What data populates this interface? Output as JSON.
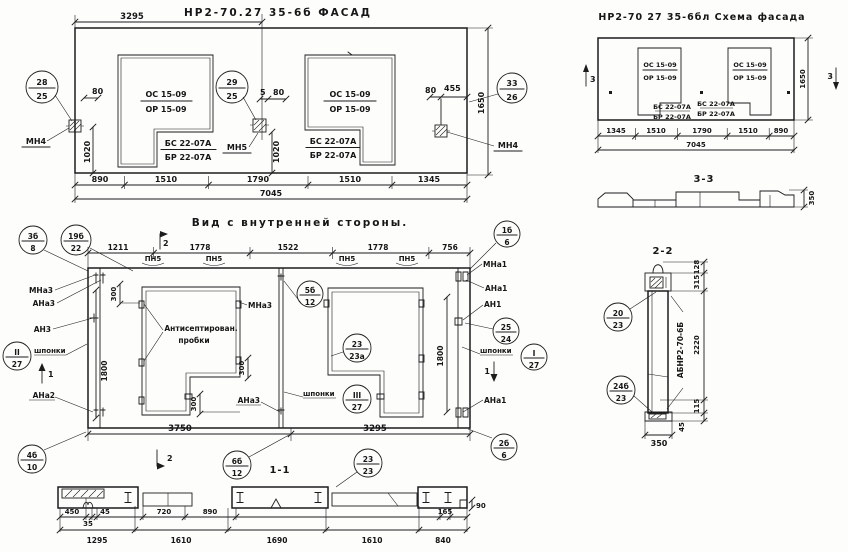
{
  "facade": {
    "title": "НР2-70.27 35-6б  ФАСАД",
    "dim_3295": "3295",
    "c28": {
      "n": "28",
      "d": "25"
    },
    "c29": {
      "n": "29",
      "d": "25"
    },
    "c33": {
      "n": "33",
      "d": "26"
    },
    "mn4_left": "МН4",
    "mn5": "МН5",
    "mn4_right": "МН4",
    "d80l": "80",
    "d1020l": "1020",
    "d5": "5",
    "d80m": "80",
    "d1020m": "1020",
    "d80r": "80",
    "d455": "455",
    "d1650": "1650",
    "w1": {
      "a": "ОС 15-09",
      "b": "ОР 15-09",
      "c": "БС 22-07А",
      "d": "БР 22-07А"
    },
    "w2": {
      "a": "ОС 15-09",
      "b": "ОР 15-09",
      "c": "БС 22-07А",
      "d": "БР 22-07А"
    },
    "db": [
      "890",
      "1510",
      "1790",
      "1510",
      "1345"
    ],
    "total": "7045"
  },
  "schema": {
    "title": "НР2-70 27 35-6бл  Схема фасада",
    "w1": {
      "a": "ОС 15-09",
      "b": "ОР 15-09",
      "c": "БС 22-07А",
      "d": "БР 22-07А"
    },
    "w2": {
      "a": "ОС 15-09",
      "b": "ОР 15-09",
      "c": "БС 22-07А",
      "d": "БР 22-07А"
    },
    "m3": "3",
    "d1650": "1650",
    "db": [
      "1345",
      "1510",
      "1790",
      "1510",
      "890"
    ],
    "total": "7045",
    "sec": "3-3",
    "d350": "350"
  },
  "inner": {
    "title": "Вид с внутренней стороны.",
    "c3b8": {
      "n": "3б",
      "d": "8"
    },
    "c19b22": {
      "n": "19б",
      "d": "22"
    },
    "c1b6": {
      "n": "1б",
      "d": "6"
    },
    "c2b6": {
      "n": "2б",
      "d": "6"
    },
    "c4b10": {
      "n": "4б",
      "d": "10"
    },
    "c5b12": {
      "n": "5б",
      "d": "12"
    },
    "c6b12": {
      "n": "6б",
      "d": "12"
    },
    "c23a": {
      "n": "23",
      "d": "23а"
    },
    "c2323": {
      "n": "23",
      "d": "23"
    },
    "c2524": {
      "n": "25",
      "d": "24"
    },
    "cI27": {
      "n": "I",
      "d": "27"
    },
    "cII27": {
      "n": "II",
      "d": "27"
    },
    "cIII27": {
      "n": "III",
      "d": "27"
    },
    "dt": [
      "1211",
      "1778",
      "1522",
      "1778",
      "756"
    ],
    "pn5": "ПН5",
    "m1": "1",
    "m2": "2",
    "mna3": "МНа3",
    "ana3": "АНа3",
    "an3": "АН3",
    "shponki": "шпонки",
    "ana2": "АНа2",
    "mna1": "МНа1",
    "ana1": "АНа1",
    "an1": "АН1",
    "anti1": "Антисептирован.",
    "anti2": "пробки",
    "d300": "300",
    "d1800": "1800",
    "d3750": "3750",
    "d3295": "3295",
    "sec": "1-1"
  },
  "s11": {
    "r1": [
      "450",
      "35",
      "45",
      "720",
      "890",
      "165",
      "90"
    ],
    "r2": [
      "1295",
      "1610",
      "1690",
      "1610",
      "840"
    ]
  },
  "s22": {
    "title": "2-2",
    "c2023": {
      "n": "20",
      "d": "23"
    },
    "c24b23": {
      "n": "24б",
      "d": "23"
    },
    "label": "АБНР2-70-6Б",
    "d128": "128",
    "d315": "315",
    "d2220": "2220",
    "d115": "115",
    "d45": "45",
    "d350": "350"
  }
}
